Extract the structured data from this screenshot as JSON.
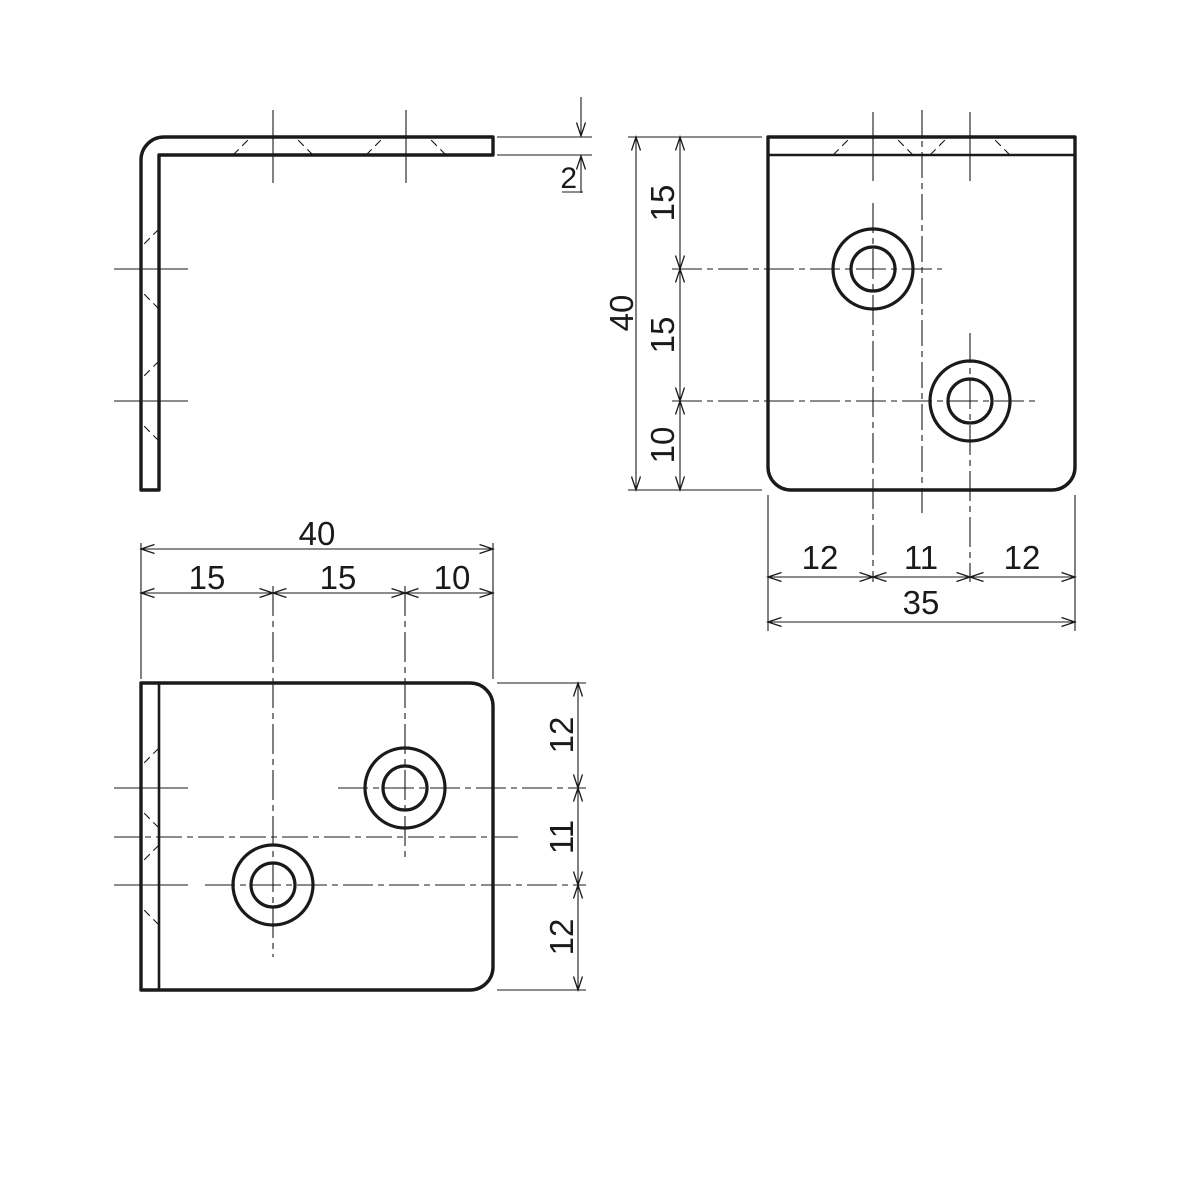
{
  "page": {
    "background": "#ffffff",
    "ink": "#1a1a1a"
  },
  "views": {
    "side": {
      "dims": {
        "thickness": "2"
      }
    },
    "top": {
      "dims": {
        "height_total": "40",
        "height_seg1": "15",
        "height_seg2": "15",
        "height_seg3": "10",
        "width_seg1": "12",
        "width_seg2": "11",
        "width_seg3": "12",
        "width_total": "35"
      }
    },
    "front": {
      "dims": {
        "width_total": "40",
        "width_seg1": "15",
        "width_seg2": "15",
        "width_seg3": "10",
        "height_seg1": "12",
        "height_seg2": "11",
        "height_seg3": "12"
      }
    }
  }
}
